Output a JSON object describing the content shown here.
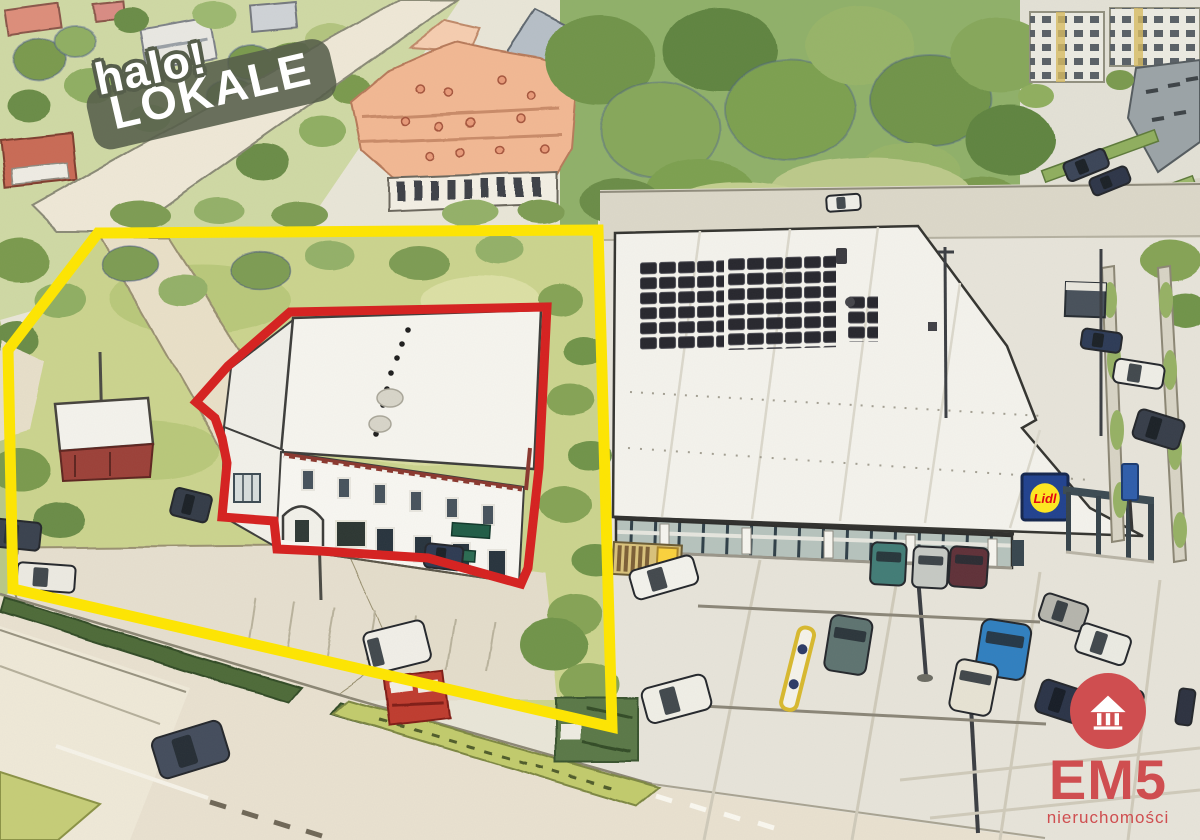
{
  "branding": {
    "halo_logo": {
      "line1": "halo!",
      "line2": "LOKALE",
      "pill_color": "#565e4b",
      "text_color": "#ffffff"
    },
    "em5_logo": {
      "name": "EM5",
      "subtitle": "nieruchomości",
      "color": "#cf4e50",
      "icon": "house-columns-icon"
    }
  },
  "lidl_sign": {
    "text": "Lidl",
    "blue": "#20418f",
    "yellow": "#ffe71f",
    "red": "#e3000f"
  },
  "annotations": {
    "property_outline": {
      "color": "#ffe600",
      "stroke_width": "11",
      "points": "98,233 598,230 612,727 13,589 8,350"
    },
    "building_outline": {
      "color": "#d6201f",
      "stroke_width": "9",
      "points": "290,312 547,307 539,468 528,568 521,584 428,558 320,551 277,549 274,521 222,517 227,463 222,438 215,418 196,402 228,366"
    }
  }
}
